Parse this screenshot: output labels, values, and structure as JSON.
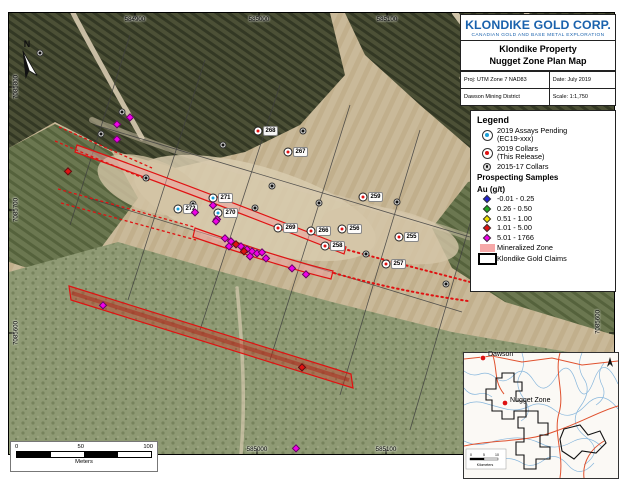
{
  "title_block": {
    "company": "KLONDIKE GOLD CORP.",
    "tagline": "CANADIAN GOLD AND BASE METAL EXPLORATION",
    "property": "Klondike Property",
    "map_title": "Nugget Zone Plan Map",
    "projection": "Proj: UTM Zone 7 NAD83",
    "date": "Date: July 2019",
    "district": "Dawson Mining District",
    "scale": "Scale: 1:1,750"
  },
  "legend": {
    "title": "Legend",
    "collar_items": [
      {
        "label1": "2019 Assays Pending",
        "label2": "(EC19-xxx)",
        "color": "#1ba0d8"
      },
      {
        "label1": "2019 Collars",
        "label2": "(This Release)",
        "color": "#e01212"
      },
      {
        "label1": "2015-17 Collars",
        "label2": "",
        "color": "#111111"
      }
    ],
    "samples_heading": "Prospecting Samples",
    "au_heading": "Au (g/t)",
    "sample_classes": [
      {
        "label": "-0.01 - 0.25",
        "color": "#2020d0"
      },
      {
        "label": "0.26 - 0.50",
        "color": "#1fa81f"
      },
      {
        "label": "0.51 - 1.00",
        "color": "#f0e000"
      },
      {
        "label": "1.01 - 5.00",
        "color": "#e01212"
      },
      {
        "label": "5.01 - 1766",
        "color": "#f000e8"
      }
    ],
    "zone_label": "Mineralized Zone",
    "zone_color": "#f6a8a8",
    "claims_label": "Klondike Gold Claims"
  },
  "map": {
    "north_label": "N",
    "grid": {
      "top": [
        {
          "t": "584900",
          "x": 135
        },
        {
          "t": "585000",
          "x": 259
        },
        {
          "t": "585100",
          "x": 387
        }
      ],
      "bottom": [
        {
          "t": "585000",
          "x": 257
        },
        {
          "t": "585100",
          "x": 386
        }
      ],
      "left": [
        {
          "t": "7085800",
          "y": 87
        },
        {
          "t": "7085700",
          "y": 210
        },
        {
          "t": "7085600",
          "y": 333
        }
      ],
      "right": [
        {
          "t": "7085600",
          "y": 322
        }
      ]
    },
    "collars_pending": [
      {
        "id": "272",
        "x": 178,
        "y": 209
      },
      {
        "id": "271",
        "x": 213,
        "y": 198
      },
      {
        "id": "270",
        "x": 218,
        "y": 213
      }
    ],
    "collars_2019": [
      {
        "id": "268",
        "x": 258,
        "y": 131
      },
      {
        "id": "267",
        "x": 288,
        "y": 152
      },
      {
        "id": "259",
        "x": 363,
        "y": 197
      },
      {
        "id": "269",
        "x": 278,
        "y": 228
      },
      {
        "id": "266",
        "x": 311,
        "y": 231
      },
      {
        "id": "256",
        "x": 342,
        "y": 229
      },
      {
        "id": "258",
        "x": 325,
        "y": 246
      },
      {
        "id": "255",
        "x": 399,
        "y": 237
      },
      {
        "id": "257",
        "x": 386,
        "y": 264
      }
    ],
    "collars_old": [
      {
        "x": 40,
        "y": 53
      },
      {
        "x": 122,
        "y": 112
      },
      {
        "x": 101,
        "y": 134
      },
      {
        "x": 223,
        "y": 145
      },
      {
        "x": 303,
        "y": 131
      },
      {
        "x": 146,
        "y": 178
      },
      {
        "x": 193,
        "y": 204
      },
      {
        "x": 272,
        "y": 186
      },
      {
        "x": 255,
        "y": 208
      },
      {
        "x": 319,
        "y": 203
      },
      {
        "x": 397,
        "y": 202
      },
      {
        "x": 366,
        "y": 254
      },
      {
        "x": 446,
        "y": 284
      }
    ],
    "samples": [
      {
        "c": "magenta",
        "x": 130,
        "y": 117
      },
      {
        "c": "magenta",
        "x": 117,
        "y": 124
      },
      {
        "c": "magenta",
        "x": 117,
        "y": 139
      },
      {
        "c": "red",
        "x": 68,
        "y": 171
      },
      {
        "c": "magenta",
        "x": 213,
        "y": 205
      },
      {
        "c": "magenta",
        "x": 195,
        "y": 212
      },
      {
        "c": "magenta",
        "x": 217,
        "y": 219
      },
      {
        "c": "magenta",
        "x": 216,
        "y": 221
      },
      {
        "c": "magenta",
        "x": 225,
        "y": 238
      },
      {
        "c": "magenta",
        "x": 231,
        "y": 241
      },
      {
        "c": "red",
        "x": 236,
        "y": 244
      },
      {
        "c": "magenta",
        "x": 229,
        "y": 246
      },
      {
        "c": "magenta",
        "x": 241,
        "y": 246
      },
      {
        "c": "magenta",
        "x": 247,
        "y": 249
      },
      {
        "c": "red",
        "x": 244,
        "y": 251
      },
      {
        "c": "magenta",
        "x": 252,
        "y": 251
      },
      {
        "c": "magenta",
        "x": 257,
        "y": 253
      },
      {
        "c": "magenta",
        "x": 262,
        "y": 252
      },
      {
        "c": "magenta",
        "x": 250,
        "y": 256
      },
      {
        "c": "magenta",
        "x": 266,
        "y": 258
      },
      {
        "c": "magenta",
        "x": 292,
        "y": 268
      },
      {
        "c": "magenta",
        "x": 306,
        "y": 274
      },
      {
        "c": "magenta",
        "x": 103,
        "y": 305
      },
      {
        "c": "red",
        "x": 302,
        "y": 367
      },
      {
        "c": "magenta",
        "x": 296,
        "y": 448
      }
    ],
    "sample_colors": {
      "magenta": "#f000e8",
      "red": "#e01212"
    },
    "scalebar": {
      "ticks": [
        "0",
        "50",
        "100"
      ],
      "units": "Meters"
    }
  },
  "inset": {
    "labels": [
      {
        "t": "Dawson"
      },
      {
        "t": "Nugget Zone"
      }
    ],
    "scalebar_ticks": [
      "0",
      "5",
      "10"
    ],
    "scalebar_units": "Kilometers"
  }
}
